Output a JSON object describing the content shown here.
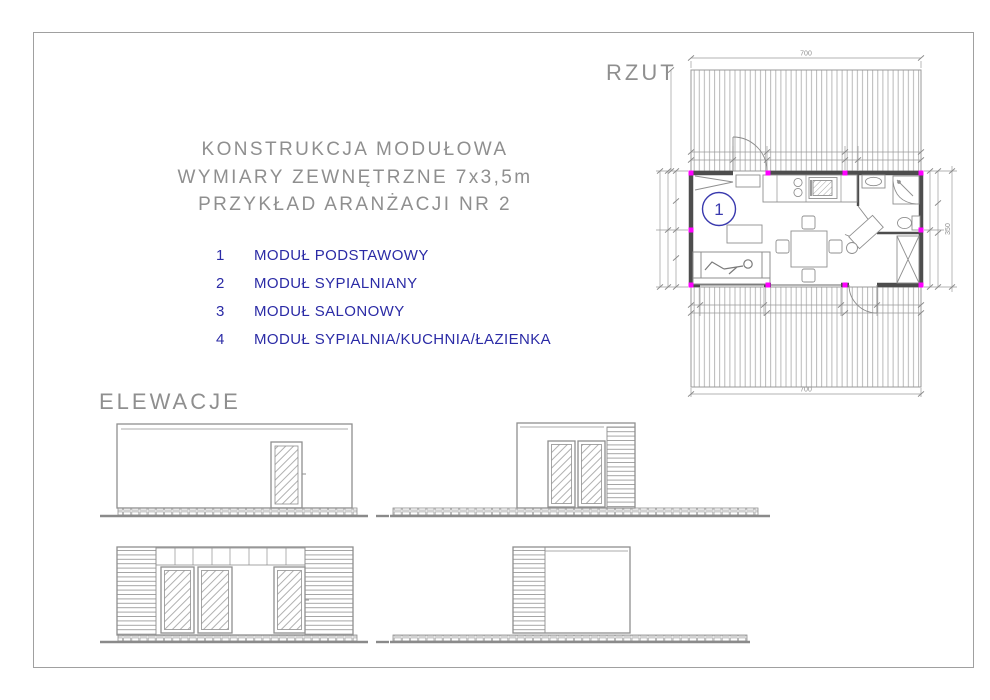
{
  "sheet": {
    "title_lines": [
      "KONSTRUKCJA MODUŁOWA",
      "WYMIARY ZEWNĘTRZNE 7x3,5m",
      "PRZYKŁAD ARANŻACJI NR 2"
    ]
  },
  "legend": {
    "items": [
      {
        "num": "1",
        "label": "MODUŁ PODSTAWOWY"
      },
      {
        "num": "2",
        "label": "MODUŁ SYPIALNIANY"
      },
      {
        "num": "3",
        "label": "MODUŁ SALONOWY"
      },
      {
        "num": "4",
        "label": "MODUŁ SYPIALNIA/KUCHNIA/ŁAZIENKA"
      }
    ]
  },
  "plan": {
    "label": "RZUT",
    "module_marker": "1",
    "dim_width_top": "700",
    "dim_width_bottom": "700",
    "dim_height_right": "350"
  },
  "elevations": {
    "label": "ELEWACJE"
  },
  "colors": {
    "legend_blue": "#2b2ba6",
    "marker_blue": "#3a3aae",
    "module_magenta": "#ff00ff",
    "line_gray": "#8f8f8f",
    "wall_dark": "#4d4d4d"
  }
}
